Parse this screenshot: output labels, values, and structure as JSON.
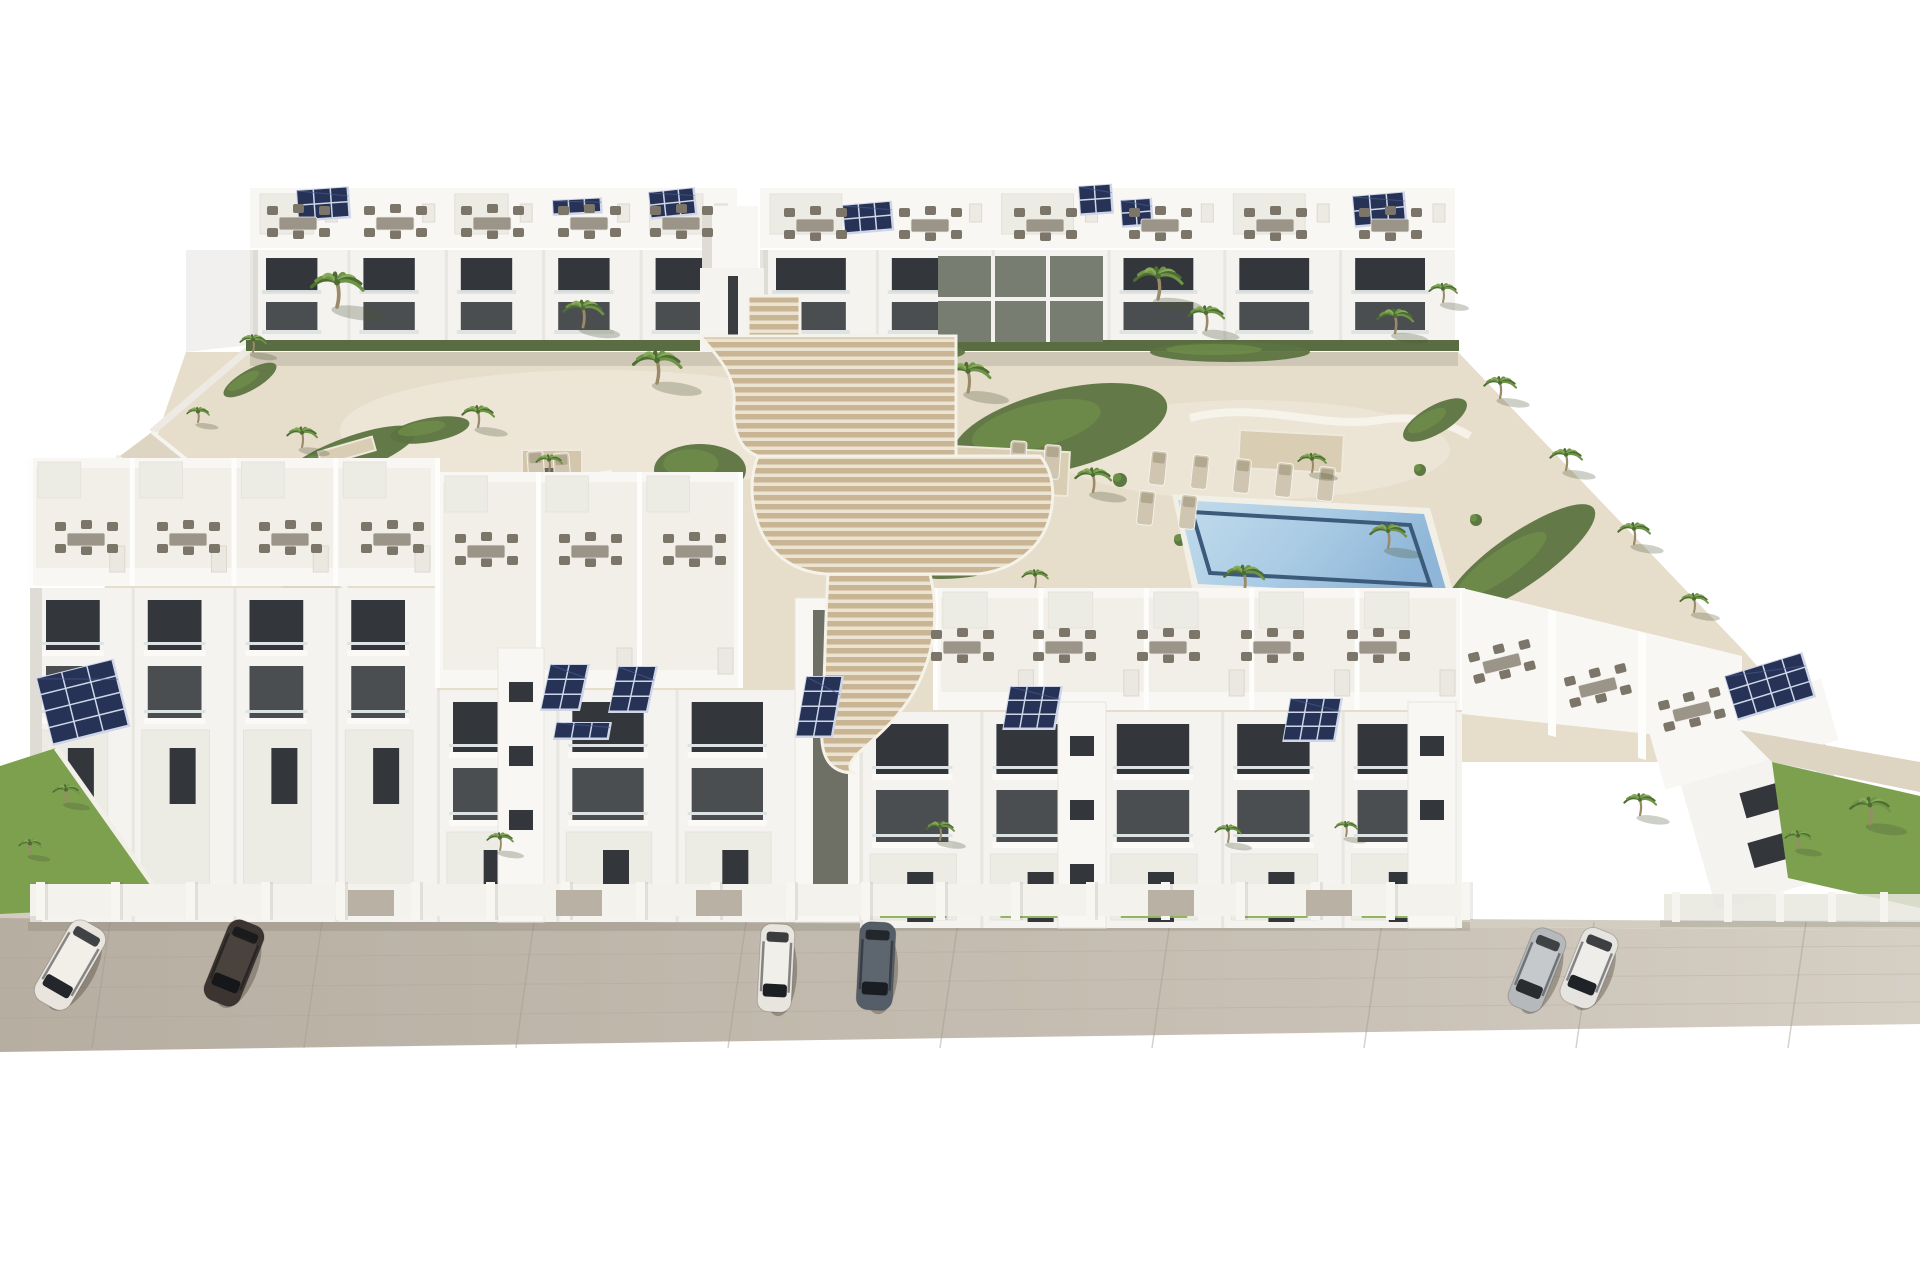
{
  "meta": {
    "type": "3d-architectural-render",
    "subject": "aerial view of white apartment complex with two pools, central wooden staircase, palm trees, rooftop solar panels and street parking"
  },
  "palette": {
    "bg": "#ffffff",
    "wall": "#f4f3f0",
    "wallBright": "#f8f7f4",
    "wallDim": "#ecebe4",
    "sideFace": "#dfdcd6",
    "opening": "#33363a",
    "opening2": "#4a4e50",
    "glassRail": "#dde3e2",
    "hedge": "#5a6c41",
    "grass": "#7da04f",
    "grassLight": "#93b561",
    "bedGreen": "#5c7440",
    "bedLight": "#71904c",
    "paving": "#e6ddcb",
    "pavingLight": "#f0eadb",
    "gravel": "#ddd4c1",
    "wood": "#c9b593",
    "woodGap": "#ece4d2",
    "street": "#b7aea2",
    "streetLight": "#c9c1b5",
    "seam": "#a49c90",
    "curb": "#d3ccc0",
    "poolDeep": "#6d98cc",
    "poolLight": "#94b9e0",
    "poolRight": "#a9cbe4",
    "poolRightLight": "#c2dbec",
    "poolRightDark": "#3c5a7a",
    "panel": "#273356",
    "panelLine": "#cfd6e8",
    "furnTable": "#9a9489",
    "furnChair": "#7c7569",
    "lounger": "#cfc5b0",
    "trunk": "#9a8a6a",
    "palmDark": "#4d6d33",
    "palmMid": "#6f9347",
    "palmLight": "#87ab5b",
    "carShadow": "rgba(60,55,45,0.35)",
    "shade": "rgba(90,85,70,0.16)"
  },
  "street": {
    "piers": 20,
    "pier_start": 36,
    "pier_step": 75,
    "gates": [
      348,
      556,
      696,
      1148,
      1306
    ]
  },
  "back_row": {
    "blocks": [
      {
        "x0": 250,
        "x1": 737,
        "roofY": 188,
        "units": 5
      },
      {
        "x0": 760,
        "x1": 1455,
        "roofY": 188,
        "units": 6
      }
    ]
  },
  "front_row": {
    "blocks": [
      {
        "x0": 30,
        "tx0": 30,
        "tx1": 437,
        "fx0": 30,
        "fx1": 437,
        "terraceY": 458,
        "facadeY": 588,
        "baseY": 922,
        "units": 4
      },
      {
        "x0": 437,
        "tx0": 437,
        "tx1": 740,
        "fx0": 437,
        "fx1": 795,
        "terraceY": 472,
        "facadeY": 690,
        "baseY": 922,
        "units": 3
      },
      {
        "x0": 860,
        "tx0": 935,
        "tx1": 1462,
        "fx0": 860,
        "fx1": 1462,
        "terraceY": 588,
        "facadeY": 712,
        "baseY": 928,
        "units": 5
      }
    ],
    "towers": [
      {
        "x": 498,
        "y": 648,
        "w": 46,
        "h": 274,
        "wins": 3,
        "slot": false
      },
      {
        "x": 1058,
        "y": 702,
        "w": 48,
        "h": 226,
        "wins": 3,
        "slot": false
      },
      {
        "x": 1408,
        "y": 702,
        "w": 48,
        "h": 226,
        "wins": 2,
        "slot": false
      },
      {
        "x": 795,
        "y": 598,
        "w": 65,
        "h": 324,
        "wins": 0,
        "slot": true
      }
    ]
  },
  "solar_arrays": [
    {
      "x": 296,
      "y": 190,
      "cols": 3,
      "rows": 2,
      "cw": 17,
      "ch": 15,
      "rot": -4,
      "skx": 0
    },
    {
      "x": 552,
      "y": 200,
      "cols": 3,
      "rows": 1,
      "cw": 16,
      "ch": 14,
      "rot": -3,
      "skx": 0
    },
    {
      "x": 648,
      "y": 192,
      "cols": 3,
      "rows": 2,
      "cw": 15,
      "ch": 13,
      "rot": -6,
      "skx": 0
    },
    {
      "x": 842,
      "y": 205,
      "cols": 3,
      "rows": 2,
      "cw": 16,
      "ch": 14,
      "rot": -5,
      "skx": 0
    },
    {
      "x": 1078,
      "y": 186,
      "cols": 2,
      "rows": 2,
      "cw": 16,
      "ch": 14,
      "rot": -4,
      "skx": 0
    },
    {
      "x": 1120,
      "y": 200,
      "cols": 2,
      "rows": 2,
      "cw": 15,
      "ch": 13,
      "rot": -4,
      "skx": 0
    },
    {
      "x": 1352,
      "y": 196,
      "cols": 3,
      "rows": 2,
      "cw": 17,
      "ch": 15,
      "rot": -5,
      "skx": 0
    },
    {
      "x": 36,
      "y": 678,
      "cols": 3,
      "rows": 4,
      "cw": 26,
      "ch": 17,
      "rot": -14,
      "skx": 0
    },
    {
      "x": 550,
      "y": 664,
      "cols": 2,
      "rows": 3,
      "cw": 19,
      "ch": 15,
      "rot": 0,
      "skx": -12
    },
    {
      "x": 618,
      "y": 666,
      "cols": 2,
      "rows": 3,
      "cw": 19,
      "ch": 15,
      "rot": 0,
      "skx": -12
    },
    {
      "x": 556,
      "y": 722,
      "cols": 3,
      "rows": 1,
      "cw": 18,
      "ch": 16,
      "rot": 0,
      "skx": -10
    },
    {
      "x": 806,
      "y": 676,
      "cols": 2,
      "rows": 4,
      "cw": 18,
      "ch": 15,
      "rot": 0,
      "skx": -10
    },
    {
      "x": 1010,
      "y": 686,
      "cols": 3,
      "rows": 3,
      "cw": 17,
      "ch": 14,
      "rot": 0,
      "skx": -10
    },
    {
      "x": 1290,
      "y": 698,
      "cols": 3,
      "rows": 3,
      "cw": 17,
      "ch": 14,
      "rot": 0,
      "skx": -10
    },
    {
      "x": 1724,
      "y": 676,
      "cols": 4,
      "rows": 3,
      "cw": 20,
      "ch": 15,
      "rot": -17,
      "skx": 0
    }
  ],
  "furniture": [
    [
      298,
      224,
      0
    ],
    [
      395,
      224,
      0
    ],
    [
      492,
      224,
      0
    ],
    [
      589,
      224,
      0
    ],
    [
      681,
      224,
      0
    ],
    [
      815,
      226,
      0
    ],
    [
      930,
      226,
      0
    ],
    [
      1045,
      226,
      0
    ],
    [
      1160,
      226,
      0
    ],
    [
      1275,
      226,
      0
    ],
    [
      1390,
      226,
      0
    ],
    [
      86,
      540,
      0
    ],
    [
      188,
      540,
      0
    ],
    [
      290,
      540,
      0
    ],
    [
      392,
      540,
      0
    ],
    [
      486,
      552,
      0
    ],
    [
      590,
      552,
      0
    ],
    [
      694,
      552,
      0
    ],
    [
      962,
      648,
      0
    ],
    [
      1064,
      648,
      0
    ],
    [
      1168,
      648,
      0
    ],
    [
      1272,
      648,
      0
    ],
    [
      1378,
      648,
      0
    ],
    [
      1502,
      664,
      -14
    ],
    [
      1598,
      688,
      -14
    ],
    [
      1692,
      712,
      -14
    ]
  ],
  "loungers": [
    [
      1158,
      468,
      6
    ],
    [
      1200,
      472,
      6
    ],
    [
      1242,
      476,
      6
    ],
    [
      1284,
      480,
      6
    ],
    [
      1326,
      484,
      6
    ],
    [
      1146,
      508,
      6
    ],
    [
      1188,
      512,
      6
    ],
    [
      536,
      468,
      -4
    ],
    [
      562,
      470,
      -4
    ],
    [
      1018,
      458,
      4
    ],
    [
      1052,
      462,
      4
    ]
  ],
  "platforms": [
    {
      "x": 952,
      "y": 446,
      "w": 118,
      "h": 44,
      "rot": 3
    },
    {
      "x": 1240,
      "y": 430,
      "w": 104,
      "h": 38,
      "rot": 3
    },
    {
      "x": 318,
      "y": 452,
      "w": 56,
      "h": 14,
      "rot": -16
    }
  ],
  "pergola": {
    "x": 522,
    "y": 450,
    "w": 60,
    "h": 48
  },
  "beds": [
    [
      470,
      492,
      60,
      16,
      -8
    ],
    [
      350,
      455,
      70,
      18,
      -20
    ],
    [
      700,
      470,
      46,
      26,
      0
    ],
    [
      640,
      540,
      40,
      12,
      8
    ],
    [
      1060,
      430,
      110,
      40,
      -14
    ],
    [
      960,
      560,
      60,
      18,
      -6
    ],
    [
      1520,
      560,
      90,
      26,
      -35
    ],
    [
      820,
      748,
      40,
      14,
      0
    ],
    [
      430,
      430,
      40,
      12,
      -10
    ],
    [
      905,
      352,
      60,
      10,
      0
    ],
    [
      1230,
      352,
      80,
      10,
      0
    ],
    [
      1435,
      420,
      36,
      14,
      -30
    ],
    [
      250,
      380,
      30,
      10,
      -30
    ]
  ],
  "bushes": [
    [
      452,
      505,
      7
    ],
    [
      498,
      520,
      6
    ],
    [
      610,
      568,
      6
    ],
    [
      668,
      562,
      7
    ],
    [
      705,
      540,
      6
    ],
    [
      948,
      470,
      7
    ],
    [
      1000,
      520,
      6
    ],
    [
      1120,
      480,
      7
    ],
    [
      1180,
      540,
      6
    ],
    [
      1420,
      470,
      6
    ],
    [
      1476,
      520,
      6
    ],
    [
      830,
      760,
      6
    ],
    [
      870,
      742,
      5
    ],
    [
      305,
      470,
      6
    ],
    [
      410,
      545,
      5
    ]
  ],
  "palms_mid": [
    [
      337,
      307,
      26
    ],
    [
      583,
      327,
      20
    ],
    [
      657,
      383,
      24
    ],
    [
      478,
      427,
      16
    ],
    [
      302,
      447,
      15
    ],
    [
      377,
      497,
      18
    ],
    [
      549,
      472,
      13
    ],
    [
      968,
      392,
      22
    ],
    [
      1158,
      299,
      24
    ],
    [
      1206,
      330,
      18
    ],
    [
      1395,
      333,
      18
    ],
    [
      1443,
      302,
      14
    ],
    [
      1500,
      398,
      16
    ],
    [
      1566,
      470,
      16
    ],
    [
      1634,
      544,
      16
    ],
    [
      1694,
      612,
      14
    ],
    [
      1312,
      472,
      14
    ],
    [
      1388,
      548,
      18
    ],
    [
      1244,
      592,
      20
    ],
    [
      1093,
      492,
      18
    ],
    [
      902,
      622,
      14
    ],
    [
      688,
      588,
      14
    ],
    [
      620,
      562,
      11
    ],
    [
      253,
      352,
      13
    ],
    [
      198,
      422,
      11
    ],
    [
      152,
      482,
      10
    ],
    [
      232,
      556,
      16
    ],
    [
      346,
      562,
      18
    ],
    [
      1035,
      587,
      13
    ]
  ],
  "palms_front": [
    [
      500,
      850,
      13
    ],
    [
      940,
      840,
      14
    ],
    [
      1228,
      842,
      13
    ],
    [
      1346,
      836,
      11
    ],
    [
      66,
      802,
      13
    ],
    [
      30,
      854,
      11
    ],
    [
      1870,
      824,
      20
    ],
    [
      1798,
      848,
      13
    ],
    [
      1640,
      815,
      16
    ]
  ],
  "cars": [
    {
      "x": 70,
      "y": 965,
      "rot": 30,
      "l": 92,
      "w": 40,
      "body": "#e9e4dd",
      "roof": "#f2efe9",
      "glass": "#23262a"
    },
    {
      "x": 234,
      "y": 963,
      "rot": 22,
      "l": 86,
      "w": 38,
      "body": "#3b3430",
      "roof": "#4a423c",
      "glass": "#15171a"
    },
    {
      "x": 776,
      "y": 968,
      "rot": 3,
      "l": 88,
      "w": 34,
      "body": "#e8e5df",
      "roof": "#f1efe9",
      "glass": "#1d2023"
    },
    {
      "x": 876,
      "y": 966,
      "rot": 3,
      "l": 88,
      "w": 36,
      "body": "#555e68",
      "roof": "#5d656f",
      "glass": "#1a1d21"
    },
    {
      "x": 1537,
      "y": 970,
      "rot": 22,
      "l": 84,
      "w": 36,
      "body": "#b6b9bb",
      "roof": "#c6c9cb",
      "glass": "#2a2d30"
    },
    {
      "x": 1589,
      "y": 968,
      "rot": 22,
      "l": 80,
      "w": 38,
      "body": "#e6e4e0",
      "roof": "#efedea",
      "glass": "#1f2226"
    }
  ]
}
